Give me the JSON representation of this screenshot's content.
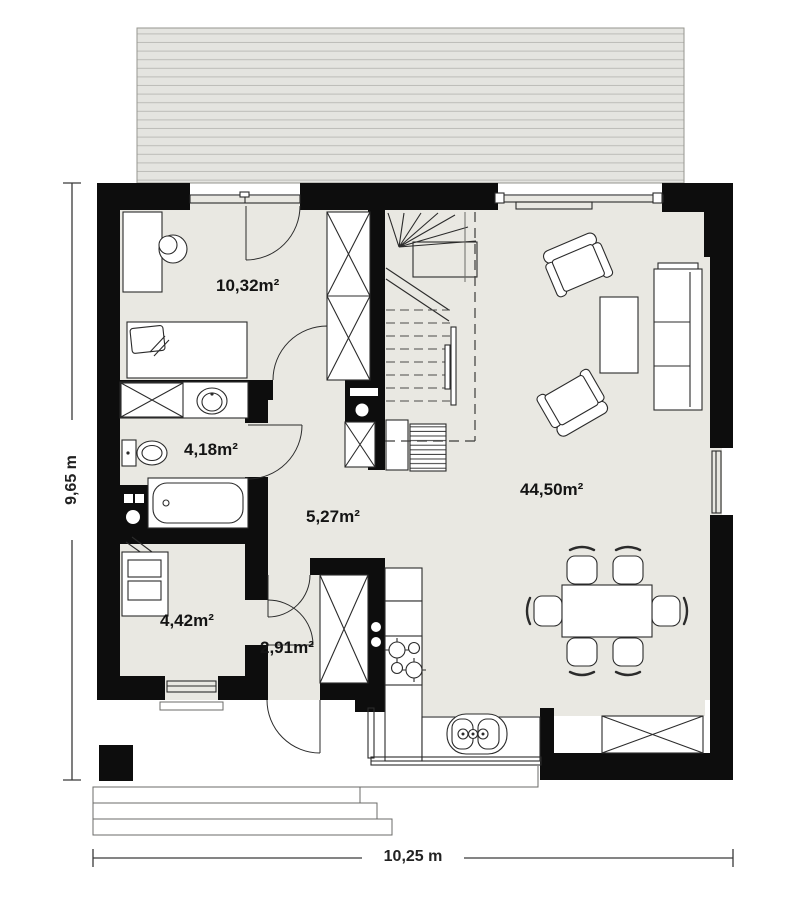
{
  "page": {
    "title": "House ground-floor plan"
  },
  "rooms": [
    {
      "name": "bedroom",
      "area": "10,32m²"
    },
    {
      "name": "bathroom",
      "area": "4,18m²"
    },
    {
      "name": "hall",
      "area": "5,27m²"
    },
    {
      "name": "utility-room",
      "area": "4,42m²"
    },
    {
      "name": "entry-hall",
      "area": "2,91m²"
    },
    {
      "name": "living-room",
      "area": "44,50m²"
    }
  ],
  "dimensions": {
    "height": "9,65 m",
    "width": "10,25 m"
  },
  "furniture": {
    "bedroom": [
      "desk",
      "chair",
      "single-bed",
      "wardrobe"
    ],
    "bathroom": [
      "washing-machine",
      "washbasin",
      "toilet",
      "bathtub"
    ],
    "utility_room": [
      "boiler"
    ],
    "hall": [
      "staircase",
      "radiator",
      "cabinet"
    ],
    "kitchen": [
      "tall-cabinet",
      "fridge",
      "stove",
      "double-sink",
      "counter"
    ],
    "living_room": [
      "two-armchairs",
      "coffee-table",
      "sofa",
      "dining-table",
      "six-chairs"
    ]
  },
  "colors": {
    "wall": "#0d0d0d",
    "floor": "#e9e8e2",
    "roof_fill": "#e4e4e0",
    "roof_line": "#bcbcb8",
    "outline": "#2b2b2b",
    "dim_line": "#3a3a3a"
  }
}
